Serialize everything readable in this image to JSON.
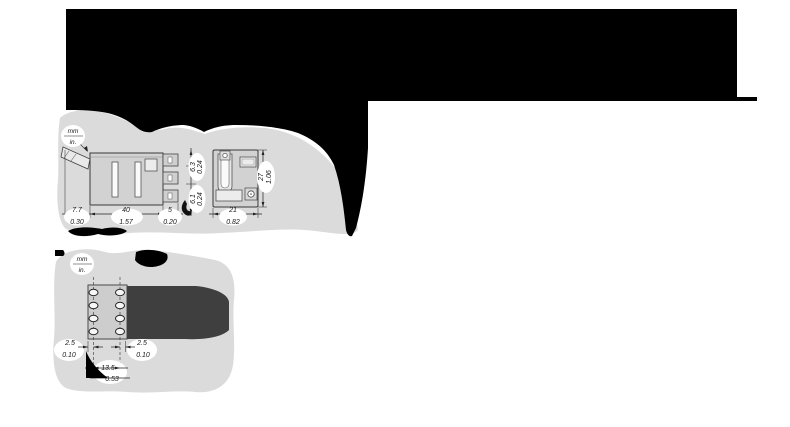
{
  "upper_drawing": {
    "units": {
      "mm": "mm",
      "in": "in."
    },
    "side_view": {
      "clip_width": {
        "mm": "7.7",
        "in": "0.30"
      },
      "depth": {
        "mm": "40",
        "in": "1.57"
      },
      "terminal_length": {
        "mm": "5",
        "in": "0.20"
      },
      "terminal_pitch_top": {
        "mm": "6.3",
        "in": "0.24"
      },
      "terminal_pitch_bottom": {
        "mm": "6.1",
        "in": "0.24"
      }
    },
    "front_view": {
      "width": {
        "mm": "21",
        "in": "0.82"
      },
      "height": {
        "mm": "27",
        "in": "1.06"
      }
    }
  },
  "lower_drawing": {
    "units": {
      "mm": "mm",
      "in": "in."
    },
    "offset_left": {
      "mm": "2.5",
      "in": "0.10"
    },
    "offset_right": {
      "mm": "2.5",
      "in": "0.10"
    },
    "hole_spacing": {
      "mm": "13.5",
      "in": "0.53"
    }
  },
  "colors": {
    "redaction_black": "#000000",
    "background_blob": "#dbdbdb",
    "device_body": "#d2d2d2",
    "dark_blob": "#3f3f3f"
  }
}
